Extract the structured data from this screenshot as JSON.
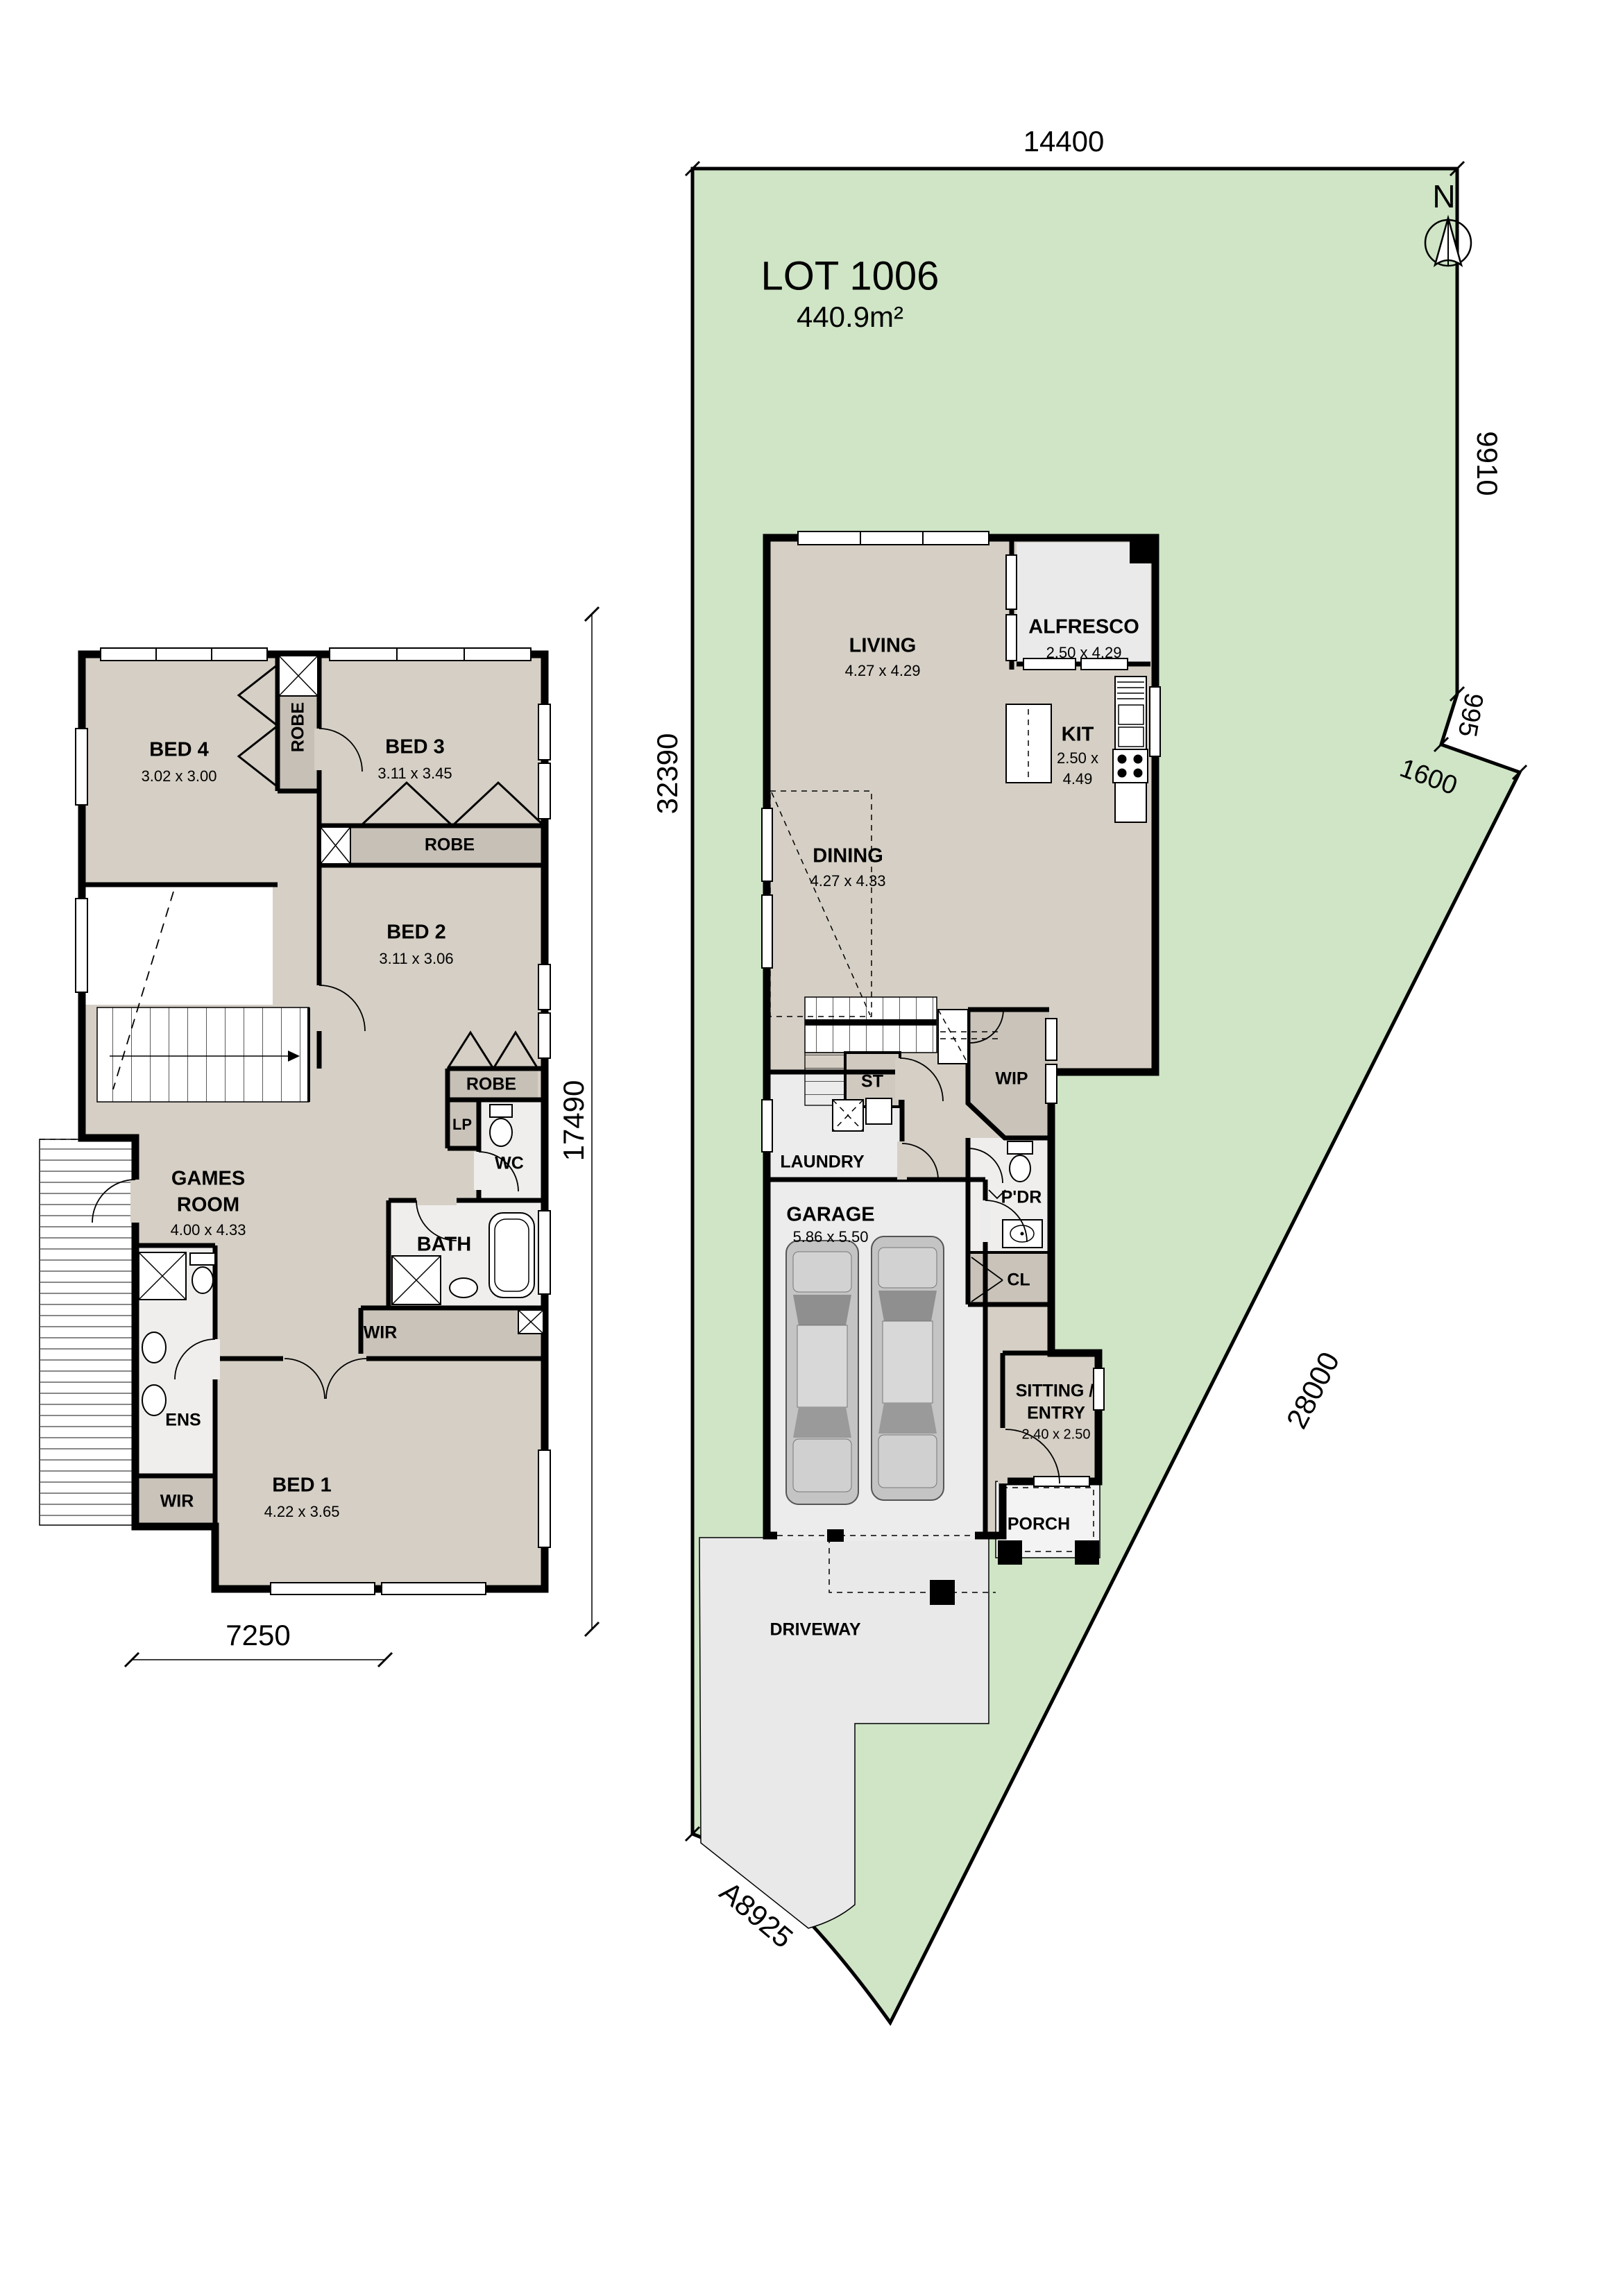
{
  "palette": {
    "lot_green": "#cfe5c6",
    "floor_beige": "#d5cfc5",
    "room_light_gray": "#ececec",
    "robe_gray": "#c6c0b7",
    "storage_gray": "#c9c3ba",
    "driveway_gray": "#e9e9e9",
    "wall_black": "#000000"
  },
  "site_plan": {
    "lot": {
      "title": "LOT 1006",
      "area": "440.9m²"
    },
    "north": "N",
    "dimensions": {
      "top": "14400",
      "right": "9910",
      "notch": "995",
      "splay": "1600",
      "diagonal": "28000",
      "left": "32390",
      "frontage": "A8925"
    },
    "rooms": {
      "living": {
        "name": "LIVING",
        "dims": "4.27 x 4.29"
      },
      "alfresco": {
        "name": "ALFRESCO",
        "dims": "2.50 x 4.29"
      },
      "dining": {
        "name": "DINING",
        "dims": "4.27 x 4.33"
      },
      "kitchen": {
        "name": "KIT",
        "dims_line1": "2.50 x",
        "dims_line2": "4.49"
      },
      "wip": {
        "name": "WIP"
      },
      "stair_store": {
        "name": "ST"
      },
      "laundry": {
        "name": "LAUNDRY"
      },
      "garage": {
        "name": "GARAGE",
        "dims": "5.86 x 5.50"
      },
      "powder": {
        "name": "P'DR"
      },
      "closet": {
        "name": "CL"
      },
      "sitting": {
        "name_line1": "SITTING /",
        "name_line2": "ENTRY",
        "dims": "2.40 x 2.50"
      },
      "porch": {
        "name": "PORCH"
      },
      "driveway": {
        "name": "DRIVEWAY"
      }
    }
  },
  "floor_plan": {
    "dimensions": {
      "height": "17490",
      "width": "7250"
    },
    "rooms": {
      "bed4": {
        "name": "BED 4",
        "dims": "3.02 x 3.00"
      },
      "bed3": {
        "name": "BED 3",
        "dims": "3.11 x 3.45"
      },
      "bed2": {
        "name": "BED 2",
        "dims": "3.11 x 3.06"
      },
      "bed1": {
        "name": "BED 1",
        "dims": "4.22 x 3.65"
      },
      "games": {
        "name_line1": "GAMES",
        "name_line2": "ROOM",
        "dims": "4.00 x 4.33"
      },
      "robe_bed4": {
        "name": "ROBE"
      },
      "robe_bed3": {
        "name": "ROBE"
      },
      "robe_bed2": {
        "name": "ROBE"
      },
      "linen": {
        "name": "LP"
      },
      "wc": {
        "name": "WC"
      },
      "bath": {
        "name": "BATH"
      },
      "ensuite": {
        "name": "ENS"
      },
      "wir_main": {
        "name": "WIR"
      },
      "wir_bed1": {
        "name": "WIR"
      }
    }
  }
}
